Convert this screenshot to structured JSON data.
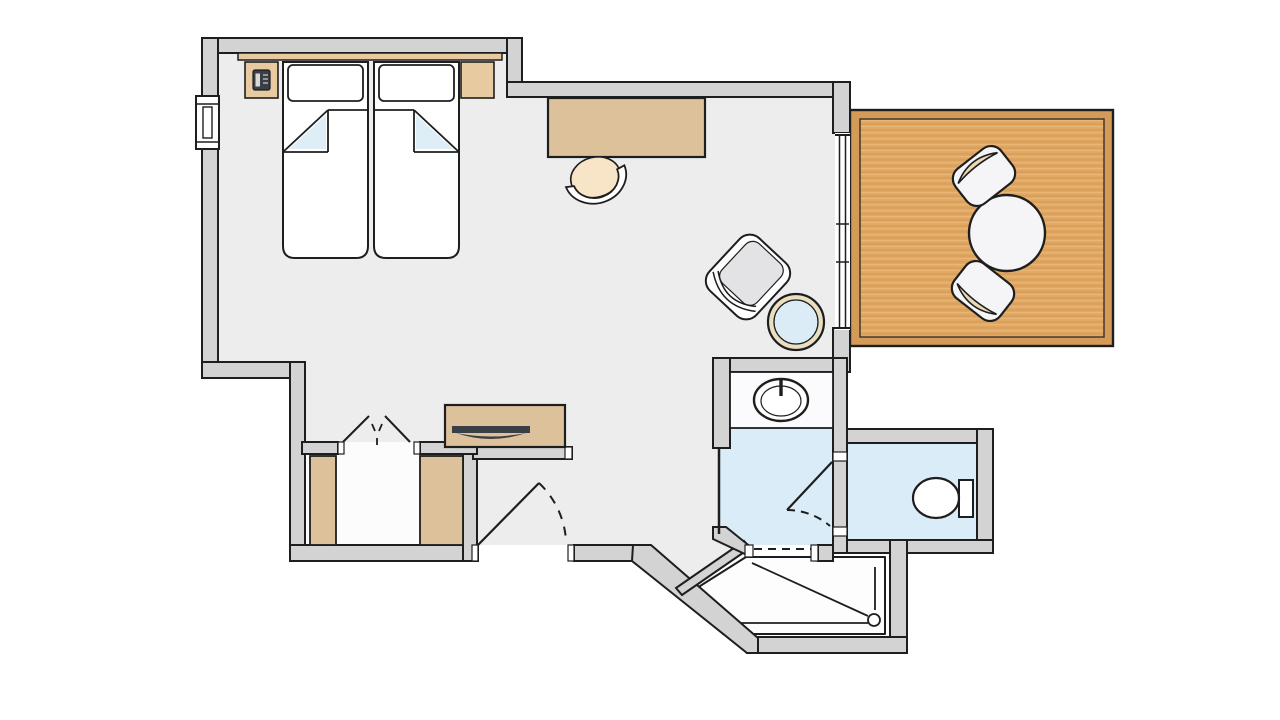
{
  "meta": {
    "title": "Hotel room floor plan",
    "type": "architectural-floor-plan",
    "visible_text": ""
  },
  "colors": {
    "background": "#ffffff",
    "wall_fill": "#d3d3d3",
    "outline": "#1e1e1e",
    "floor_main": "#ededee",
    "floor_closet": "#fcfcfc",
    "floor_bath": "#d9ecf7",
    "fold_blue": "#ddeef7",
    "wood": "#ddc19b",
    "wood_light": "#e7caa0",
    "balcony_deck": "#e1a862",
    "balcony_frame": "#d49a58",
    "seat_cream": "#f8e4c6",
    "armchair_gray": "#e3e3e5",
    "tv_dark": "#3a3f45",
    "chair_white": "#f5f5f7",
    "table_ring": "#eadfc0",
    "tray_white": "#fdfdfd"
  },
  "rooms": [
    {
      "name": "bedroom-living-room"
    },
    {
      "name": "entry-hall"
    },
    {
      "name": "closet-nook"
    },
    {
      "name": "bathroom-washbasin-room"
    },
    {
      "name": "wc-room"
    },
    {
      "name": "shower-room"
    },
    {
      "name": "balcony"
    }
  ],
  "furniture": [
    "twin-bed-left",
    "twin-bed-right",
    "pillow-left",
    "pillow-right",
    "headboard",
    "nightstand-left",
    "nightstand-right",
    "telephone",
    "desk",
    "desk-chair",
    "armchair",
    "side-table",
    "tv-sideboard",
    "tv",
    "wardrobe-left",
    "wardrobe-right",
    "washbasin",
    "toilet",
    "shower-tray",
    "balcony-table",
    "balcony-chair-top",
    "balcony-chair-bottom"
  ],
  "openings": [
    "entry-door",
    "closet-double-doors",
    "wc-door",
    "bathroom-sliding-door",
    "shower-entry",
    "balcony-sliding-door",
    "window"
  ]
}
